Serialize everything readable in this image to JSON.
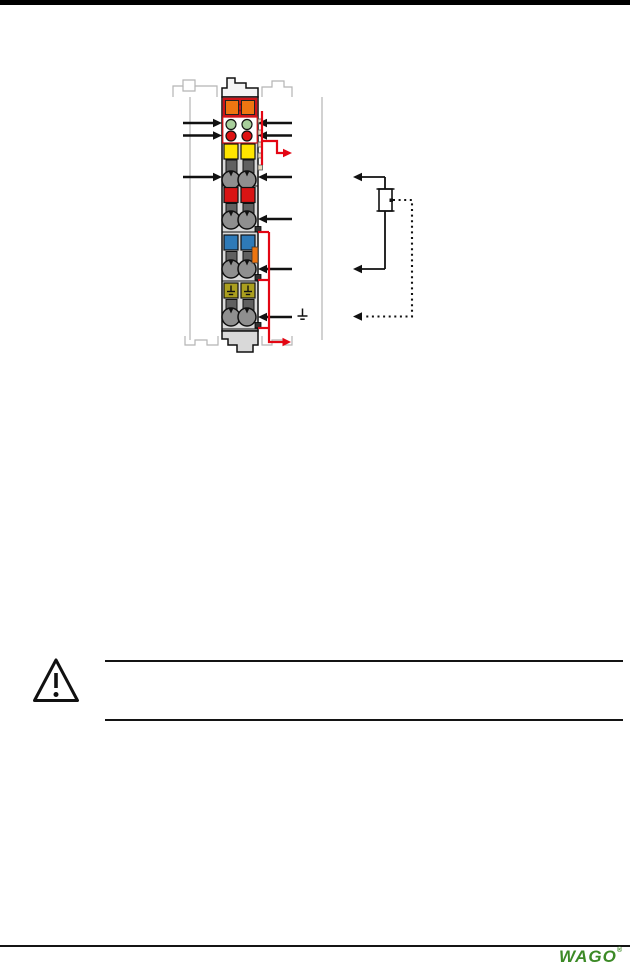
{
  "colors": {
    "top_bar": "#000000",
    "line_black": "#141414",
    "accent_red": "#e30613",
    "outline_gray": "#b5b5b5",
    "module_body": "#d9d9d9",
    "module_top_cap": "#f4f4f4",
    "connector_red": "#cf1418",
    "orange": "#ee7611",
    "led_green": "#a8cf9b",
    "led_red": "#dd1111",
    "terminal_yellow": "#ffe500",
    "terminal_dark_gray": "#606060",
    "clamp_gray": "#8f8f8f",
    "terminal_red": "#d91414",
    "terminal_blue": "#2e7ab8",
    "terminal_olive": "#ab9f1f",
    "contact_tan": "#e9dcc0",
    "jumper_contact_dark": "#333333",
    "wago_green": "#3c8a26"
  },
  "footer": {
    "logo_text": "WAGO",
    "registered_mark": "®"
  },
  "icons": {
    "warning": "warning-triangle-icon",
    "earth": "earth-ground-symbol",
    "potentiometer": "potentiometer-symbol",
    "arrow": "connection-arrow-icon"
  },
  "diagram": {
    "kind": "terminal-block-wiring-diagram",
    "led_rows": [
      {
        "name": "green-status-leds",
        "count": 2,
        "color_key": "led_green"
      },
      {
        "name": "red-status-leds",
        "count": 2,
        "color_key": "led_red"
      }
    ],
    "terminal_rows": [
      {
        "name": "yellow-terminals",
        "count": 2,
        "color_key": "terminal_yellow"
      },
      {
        "name": "red-terminals",
        "count": 2,
        "color_key": "terminal_red"
      },
      {
        "name": "blue-terminals",
        "count": 2,
        "color_key": "terminal_blue"
      },
      {
        "name": "olive-earth-terminals",
        "count": 2,
        "color_key": "terminal_olive"
      }
    ],
    "clamp_rows": 4,
    "left_arrow_count": 3,
    "right_arrow_count": 6,
    "potentiometer_arrow_count": 3
  }
}
